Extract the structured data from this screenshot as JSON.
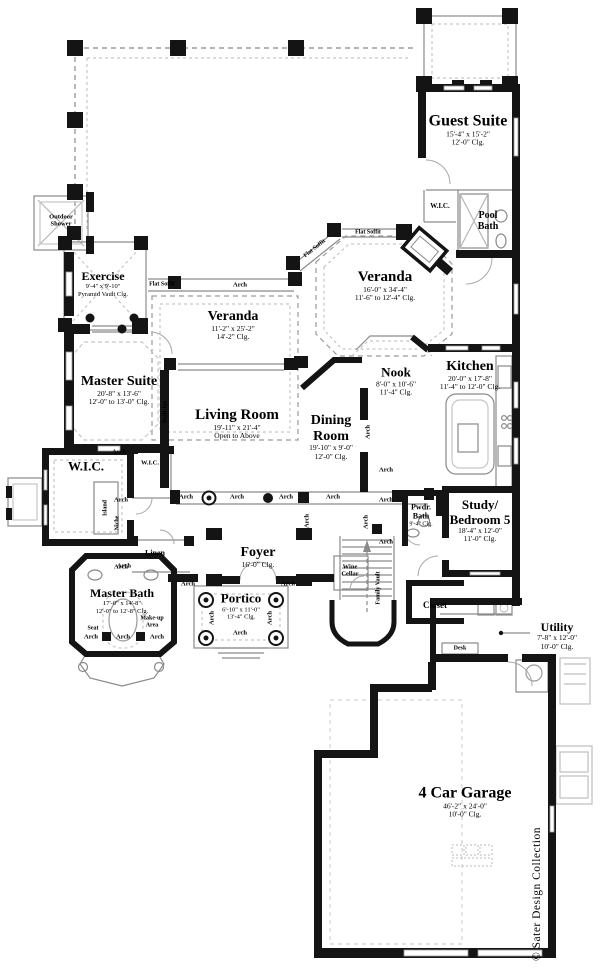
{
  "rooms": {
    "guest_suite": {
      "name": "Guest Suite",
      "dims": "15'-4\" x 15'-2\"",
      "clg": "12'-0\" Clg."
    },
    "guest_wic": {
      "name": "W.I.C."
    },
    "pool_bath": {
      "name": "Pool Bath"
    },
    "veranda_rear": {
      "name": "Veranda",
      "dims": "16'-0\" x 34'-4\"",
      "clg": "11'-6\" to 12'-4\" Clg."
    },
    "outdoor_shower": {
      "name": "Outdoor Shower"
    },
    "exercise": {
      "name": "Exercise",
      "dims": "9'-4\" x 9'-10\"",
      "clg": "Pyramid Vault Clg."
    },
    "veranda_left": {
      "name": "Veranda",
      "dims": "11'-2\" x 25'-2\"",
      "clg": "14'-2\" Clg."
    },
    "master_suite": {
      "name": "Master Suite",
      "dims": "20'-8\" x 13'-6\"",
      "clg": "12'-0\" to 13'-0\" Clg."
    },
    "living_room": {
      "name": "Living Room",
      "dims": "19'-11\" x 21'-4\"",
      "clg": "Open to Above"
    },
    "dining_room": {
      "name": "Dining Room",
      "dims": "19'-10\" x 9'-0\"",
      "clg": "12'-0\" Clg."
    },
    "nook": {
      "name": "Nook",
      "dims": "8'-0\" x 10'-6\"",
      "clg": "11'-4\" Clg."
    },
    "kitchen": {
      "name": "Kitchen",
      "dims": "20'-0\" x 17'-8\"",
      "clg": "11'-4\" to 12'-0\" Clg."
    },
    "master_wic": {
      "name": "W.I.C."
    },
    "hall_wic": {
      "name": "W.I.C."
    },
    "linen": {
      "name": "Linen"
    },
    "master_bath": {
      "name": "Master Bath",
      "dims": "17'-0\" x 14'-8\"",
      "clg": "12'-0\" to 12'-8\" Clg."
    },
    "foyer": {
      "name": "Foyer",
      "clg": "16'-0\" Clg."
    },
    "portico": {
      "name": "Portico",
      "dims": "6'-10\" x 11'-0\"",
      "clg": "13'-4\" Clg."
    },
    "wine_cellar": {
      "name": "Wine Cellar"
    },
    "powder_bath": {
      "name": "Pwdr. Bath",
      "clg": "9'-4\" Clg."
    },
    "study": {
      "name_line1": "Study/",
      "name_line2": "Bedroom 5",
      "dims": "18'-4\" x 12'-0\"",
      "clg": "11'-0\" Clg."
    },
    "closet": {
      "name": "Closet"
    },
    "utility": {
      "name": "Utility",
      "dims": "7'-8\" x 12'-0\"",
      "clg": "10'-0\" Clg."
    },
    "garage": {
      "name": "4 Car Garage",
      "dims": "46'-2\" x 24'-0\"",
      "clg": "10'-0\" Clg."
    }
  },
  "annotations": {
    "arch": "Arch",
    "flat_soffit": "Flat Soffit",
    "built_ins": "Built-Ins",
    "island": "Island",
    "niche": "Niche",
    "seat": "Seat",
    "makeup_area": "Make-up Area",
    "desk": "Desk",
    "family_vault": "Family Vault"
  },
  "branding": {
    "credit": "© Sater Design Collection"
  },
  "colors": {
    "wall": "#141414",
    "thin": "#8a8a8a",
    "dash": "#9a9a9a",
    "light": "#c6c6c6"
  }
}
